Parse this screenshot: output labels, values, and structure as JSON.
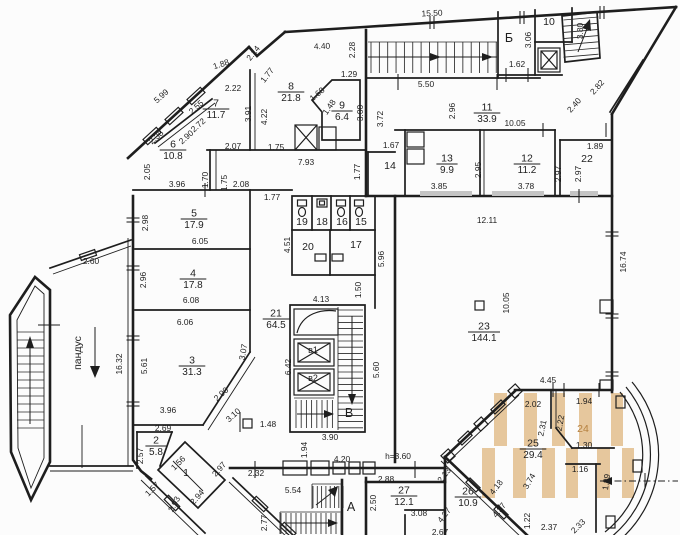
{
  "meta": {
    "background": "#fcfcfc",
    "ink": "#1e1e1e",
    "highlight": "#e6c79d",
    "accent_text": "#b5803f",
    "door_sill": "#c4c4c4"
  },
  "rooms": [
    {
      "num": "7",
      "area": "11.7",
      "x": 216,
      "y": 109
    },
    {
      "num": "6",
      "area": "10.8",
      "x": 173,
      "y": 150
    },
    {
      "num": "8",
      "area": "21.8",
      "x": 291,
      "y": 92
    },
    {
      "num": "9",
      "area": "6.4",
      "x": 342,
      "y": 111
    },
    {
      "num": "11",
      "area": "33.9",
      "x": 487,
      "y": 113
    },
    {
      "num": "13",
      "area": "9.9",
      "x": 447,
      "y": 164
    },
    {
      "num": "12",
      "area": "11.2",
      "x": 527,
      "y": 164
    },
    {
      "num": "5",
      "area": "17.9",
      "x": 194,
      "y": 219
    },
    {
      "num": "4",
      "area": "17.8",
      "x": 193,
      "y": 279
    },
    {
      "num": "3",
      "area": "31.3",
      "x": 192,
      "y": 366
    },
    {
      "num": "2",
      "area": "5.8",
      "x": 156,
      "y": 446
    },
    {
      "num": "21",
      "area": "64.5",
      "x": 276,
      "y": 319
    },
    {
      "num": "23",
      "area": "144.1",
      "x": 484,
      "y": 332
    },
    {
      "num": "25",
      "area": "29.4",
      "x": 533,
      "y": 449
    },
    {
      "num": "26",
      "area": "10.9",
      "x": 468,
      "y": 497
    },
    {
      "num": "27",
      "area": "12.1",
      "x": 404,
      "y": 496
    }
  ],
  "labels": [
    {
      "t": "10",
      "x": 549,
      "y": 22,
      "cls": "lab"
    },
    {
      "t": "14",
      "x": 390,
      "y": 166,
      "cls": "lab"
    },
    {
      "t": "22",
      "x": 587,
      "y": 159,
      "cls": "lab"
    },
    {
      "t": "19",
      "x": 302,
      "y": 222,
      "cls": "lab"
    },
    {
      "t": "18",
      "x": 322,
      "y": 222,
      "cls": "lab"
    },
    {
      "t": "16",
      "x": 342,
      "y": 222,
      "cls": "lab"
    },
    {
      "t": "15",
      "x": 361,
      "y": 222,
      "cls": "lab"
    },
    {
      "t": "20",
      "x": 308,
      "y": 247,
      "cls": "lab"
    },
    {
      "t": "17",
      "x": 356,
      "y": 245,
      "cls": "lab"
    },
    {
      "t": "1",
      "x": 186,
      "y": 473,
      "cls": "lab"
    },
    {
      "t": "24",
      "x": 583,
      "y": 429,
      "cls": "lab accent"
    },
    {
      "t": "Б",
      "x": 509,
      "y": 38,
      "cls": "big"
    },
    {
      "t": "В",
      "x": 349,
      "y": 413,
      "cls": "big"
    },
    {
      "t": "А",
      "x": 351,
      "y": 507,
      "cls": "big"
    },
    {
      "t": "в1",
      "x": 313,
      "y": 350,
      "cls": "sm"
    },
    {
      "t": "в2",
      "x": 313,
      "y": 378,
      "cls": "sm"
    },
    {
      "t": "пандус",
      "x": 78,
      "y": 353,
      "r": -90,
      "cls": "lab"
    }
  ],
  "dims": [
    {
      "t": "15.50",
      "x": 432,
      "y": 13,
      "r": -3
    },
    {
      "t": "2.14",
      "x": 253,
      "y": 53,
      "r": -52
    },
    {
      "t": "4.40",
      "x": 322,
      "y": 46,
      "r": -3
    },
    {
      "t": "2.28",
      "x": 352,
      "y": 50,
      "r": -90
    },
    {
      "t": "1.88",
      "x": 221,
      "y": 64,
      "r": -18
    },
    {
      "t": "1.77",
      "x": 267,
      "y": 75,
      "r": -52
    },
    {
      "t": "1.29",
      "x": 349,
      "y": 74
    },
    {
      "t": "1.68",
      "x": 317,
      "y": 94,
      "r": -40
    },
    {
      "t": "5.99",
      "x": 161,
      "y": 96,
      "r": -42
    },
    {
      "t": "2.22",
      "x": 233,
      "y": 88
    },
    {
      "t": "1.48",
      "x": 329,
      "y": 107,
      "r": -55
    },
    {
      "t": "2.55",
      "x": 196,
      "y": 107,
      "r": -42
    },
    {
      "t": "3.91",
      "x": 248,
      "y": 114,
      "r": -90
    },
    {
      "t": "4.22",
      "x": 264,
      "y": 117,
      "r": -90
    },
    {
      "t": "3.00",
      "x": 360,
      "y": 113,
      "r": -90
    },
    {
      "t": "3.72",
      "x": 380,
      "y": 119,
      "r": -90
    },
    {
      "t": "5.50",
      "x": 426,
      "y": 84
    },
    {
      "t": "1.62",
      "x": 517,
      "y": 64
    },
    {
      "t": "3.06",
      "x": 528,
      "y": 40,
      "r": -90
    },
    {
      "t": "3.80",
      "x": 580,
      "y": 31,
      "r": -90
    },
    {
      "t": "2.82",
      "x": 597,
      "y": 87,
      "r": -48
    },
    {
      "t": "2.40",
      "x": 574,
      "y": 105,
      "r": -48
    },
    {
      "t": "2.38",
      "x": 156,
      "y": 137,
      "r": -42
    },
    {
      "t": "2.90",
      "x": 186,
      "y": 137,
      "r": -42
    },
    {
      "t": "2.72",
      "x": 198,
      "y": 125,
      "r": -42
    },
    {
      "t": "2.07",
      "x": 233,
      "y": 146
    },
    {
      "t": "1.75",
      "x": 276,
      "y": 147
    },
    {
      "t": "7.93",
      "x": 306,
      "y": 162
    },
    {
      "t": "1.67",
      "x": 391,
      "y": 145
    },
    {
      "t": "10.05",
      "x": 515,
      "y": 123
    },
    {
      "t": "2.96",
      "x": 452,
      "y": 111,
      "r": -90
    },
    {
      "t": "1.89",
      "x": 595,
      "y": 146
    },
    {
      "t": "2.05",
      "x": 147,
      "y": 172,
      "r": -90
    },
    {
      "t": "3.96",
      "x": 177,
      "y": 184
    },
    {
      "t": "1.70",
      "x": 205,
      "y": 180,
      "r": -90
    },
    {
      "t": "1.75",
      "x": 224,
      "y": 183,
      "r": -90
    },
    {
      "t": "2.08",
      "x": 241,
      "y": 184
    },
    {
      "t": "2.95",
      "x": 478,
      "y": 170,
      "r": -90
    },
    {
      "t": "2.97",
      "x": 558,
      "y": 174,
      "r": -90
    },
    {
      "t": "2.97",
      "x": 578,
      "y": 174,
      "r": -90
    },
    {
      "t": "3.85",
      "x": 439,
      "y": 186
    },
    {
      "t": "3.78",
      "x": 526,
      "y": 186
    },
    {
      "t": "1.77",
      "x": 272,
      "y": 197
    },
    {
      "t": "1.77",
      "x": 357,
      "y": 172,
      "r": -90
    },
    {
      "t": "12.11",
      "x": 487,
      "y": 220
    },
    {
      "t": "16.74",
      "x": 623,
      "y": 262,
      "r": -90
    },
    {
      "t": "4.51",
      "x": 287,
      "y": 245,
      "r": -90
    },
    {
      "t": "5.96",
      "x": 381,
      "y": 259,
      "r": -90
    },
    {
      "t": "2.98",
      "x": 145,
      "y": 223,
      "r": -90
    },
    {
      "t": "6.05",
      "x": 200,
      "y": 241
    },
    {
      "t": "2.96",
      "x": 143,
      "y": 280,
      "r": -90
    },
    {
      "t": "6.08",
      "x": 191,
      "y": 300
    },
    {
      "t": "6.06",
      "x": 185,
      "y": 322
    },
    {
      "t": "2.60",
      "x": 91,
      "y": 261
    },
    {
      "t": "16.32",
      "x": 119,
      "y": 364,
      "r": -90
    },
    {
      "t": "1.50",
      "x": 358,
      "y": 290,
      "r": -90
    },
    {
      "t": "4.13",
      "x": 321,
      "y": 299
    },
    {
      "t": "10.05",
      "x": 506,
      "y": 303,
      "r": -90
    },
    {
      "t": "5.61",
      "x": 144,
      "y": 366,
      "r": -90
    },
    {
      "t": "3.07",
      "x": 243,
      "y": 352,
      "r": -80
    },
    {
      "t": "2.90",
      "x": 221,
      "y": 394,
      "r": -42
    },
    {
      "t": "3.10",
      "x": 233,
      "y": 415,
      "r": -42
    },
    {
      "t": "5.60",
      "x": 376,
      "y": 370,
      "r": -90
    },
    {
      "t": "6.42",
      "x": 288,
      "y": 367,
      "r": -90
    },
    {
      "t": "3.96",
      "x": 168,
      "y": 410
    },
    {
      "t": "2.69",
      "x": 163,
      "y": 428
    },
    {
      "t": "2.57",
      "x": 140,
      "y": 456,
      "r": -90
    },
    {
      "t": "1.56",
      "x": 178,
      "y": 463,
      "r": -45
    },
    {
      "t": "2.97",
      "x": 219,
      "y": 469,
      "r": -48
    },
    {
      "t": "1.57",
      "x": 152,
      "y": 489,
      "r": -45
    },
    {
      "t": "2.93",
      "x": 174,
      "y": 504,
      "r": -62
    },
    {
      "t": "2.94",
      "x": 197,
      "y": 497,
      "r": -48
    },
    {
      "t": "1.48",
      "x": 268,
      "y": 424
    },
    {
      "t": "3.90",
      "x": 330,
      "y": 437
    },
    {
      "t": "1.94",
      "x": 304,
      "y": 450,
      "r": -90
    },
    {
      "t": "4.20",
      "x": 342,
      "y": 459
    },
    {
      "t": "h=3.60",
      "x": 398,
      "y": 456
    },
    {
      "t": "2.32",
      "x": 256,
      "y": 473
    },
    {
      "t": "2.88",
      "x": 386,
      "y": 479
    },
    {
      "t": "5.54",
      "x": 293,
      "y": 490
    },
    {
      "t": "2.77",
      "x": 264,
      "y": 523,
      "r": -90
    },
    {
      "t": "2.50",
      "x": 373,
      "y": 503,
      "r": -90
    },
    {
      "t": "3.08",
      "x": 419,
      "y": 513
    },
    {
      "t": "2.67",
      "x": 440,
      "y": 532
    },
    {
      "t": "2.13",
      "x": 444,
      "y": 475,
      "r": -52
    },
    {
      "t": "4.27",
      "x": 444,
      "y": 515,
      "r": -52
    },
    {
      "t": "4.18",
      "x": 496,
      "y": 487,
      "r": -52
    },
    {
      "t": "4.37",
      "x": 499,
      "y": 510,
      "r": -52
    },
    {
      "t": "3.74",
      "x": 529,
      "y": 481,
      "r": -60
    },
    {
      "t": "1.22",
      "x": 527,
      "y": 521,
      "r": -90
    },
    {
      "t": "2.37",
      "x": 549,
      "y": 527
    },
    {
      "t": "2.33",
      "x": 578,
      "y": 526,
      "r": -45
    },
    {
      "t": "4.45",
      "x": 548,
      "y": 380
    },
    {
      "t": "2.02",
      "x": 533,
      "y": 404
    },
    {
      "t": "1.94",
      "x": 584,
      "y": 401
    },
    {
      "t": "2.22",
      "x": 560,
      "y": 423,
      "r": -80
    },
    {
      "t": "2.31",
      "x": 542,
      "y": 428,
      "r": -78
    },
    {
      "t": "1.30",
      "x": 584,
      "y": 445
    },
    {
      "t": "1.16",
      "x": 580,
      "y": 469
    },
    {
      "t": "1.89",
      "x": 606,
      "y": 482,
      "r": -82
    }
  ]
}
